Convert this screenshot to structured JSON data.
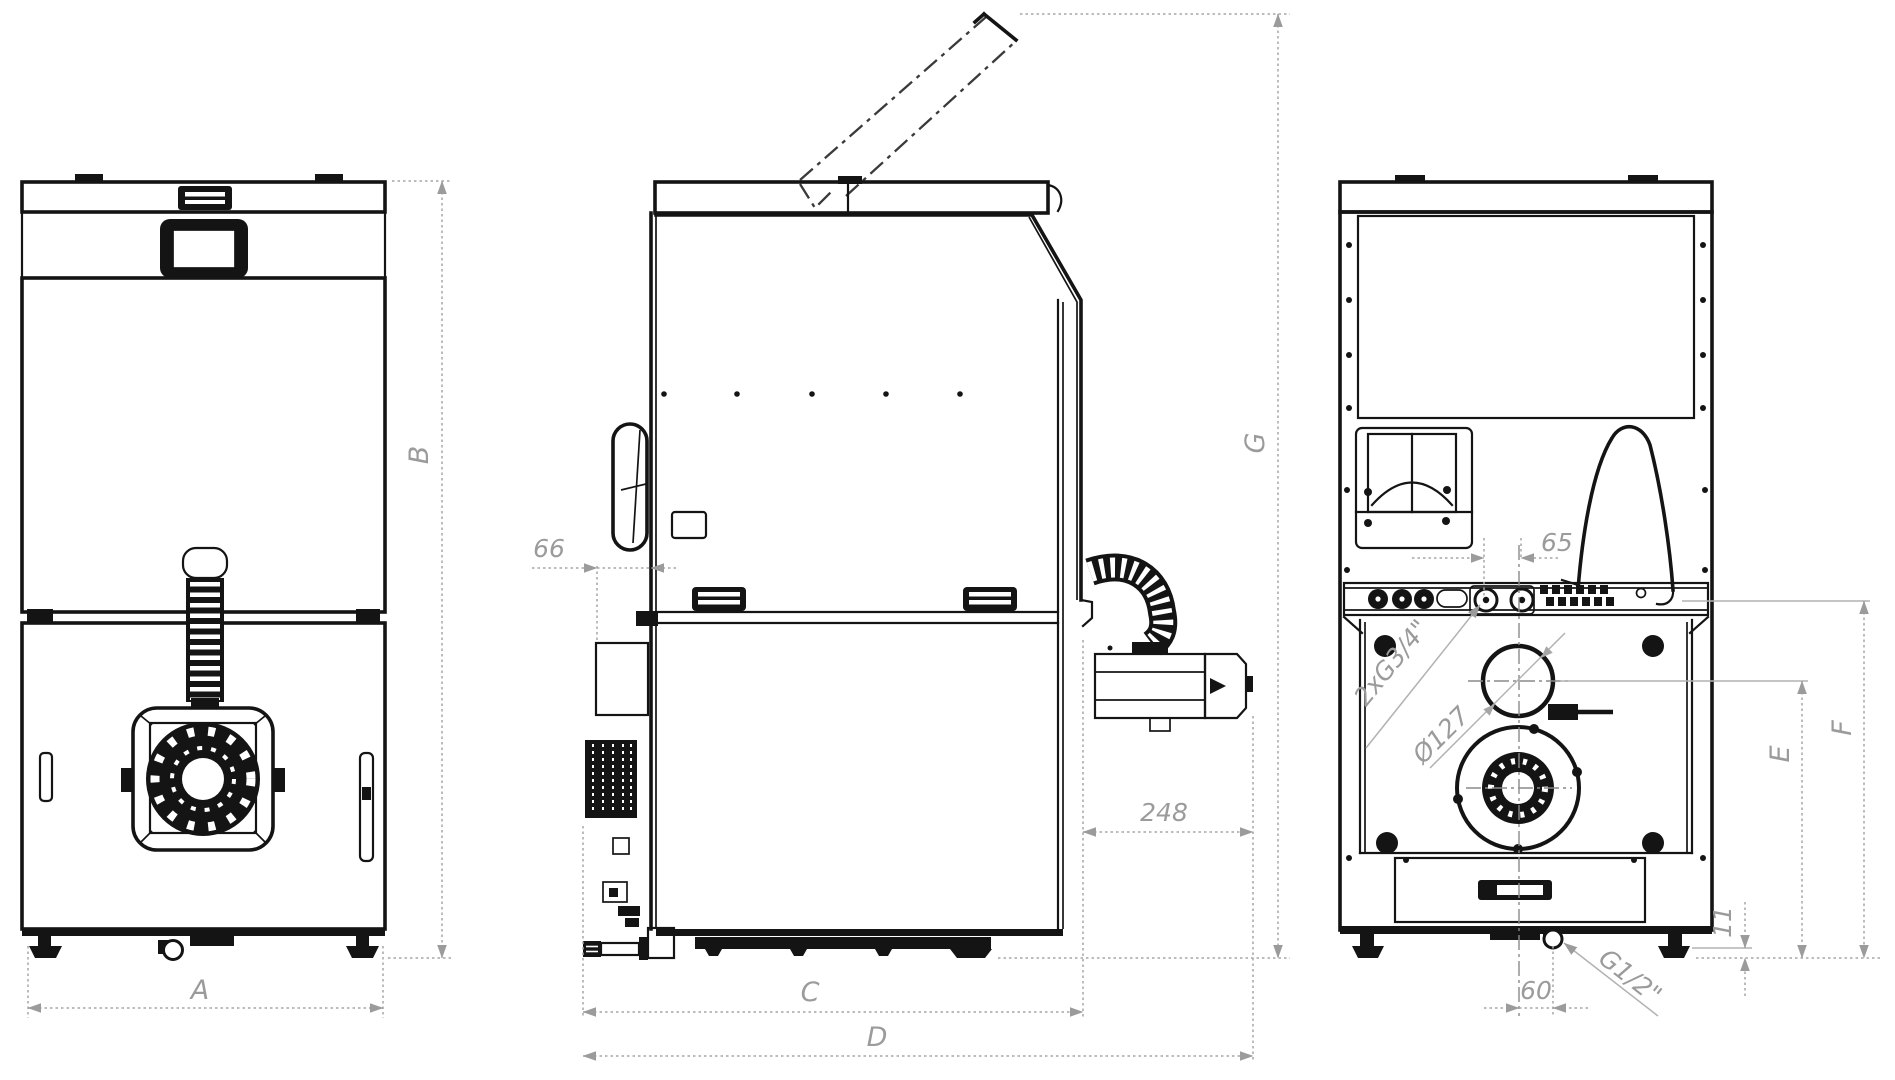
{
  "page": {
    "background": "#ffffff",
    "description": "Three-view dimensional technical line drawing of a pellet boiler (front, side, rear)"
  },
  "colors": {
    "outline": "#141414",
    "dimension_gray": "#9b9b9b"
  },
  "views": {
    "front_view": {
      "name": "front view"
    },
    "side_view": {
      "name": "side view with lid open"
    },
    "rear_view": {
      "name": "rear view with connections"
    }
  },
  "labels": {
    "A": "A",
    "B": "B",
    "C": "C",
    "D": "D",
    "E": "E",
    "F": "F",
    "G": "G",
    "n66": "66",
    "n248": "248",
    "n65": "65",
    "n60": "60",
    "n11": "11",
    "thread_top": "2xG3/4\"",
    "flue_diameter": "Ø127",
    "drain_thread": "G1/2\""
  }
}
